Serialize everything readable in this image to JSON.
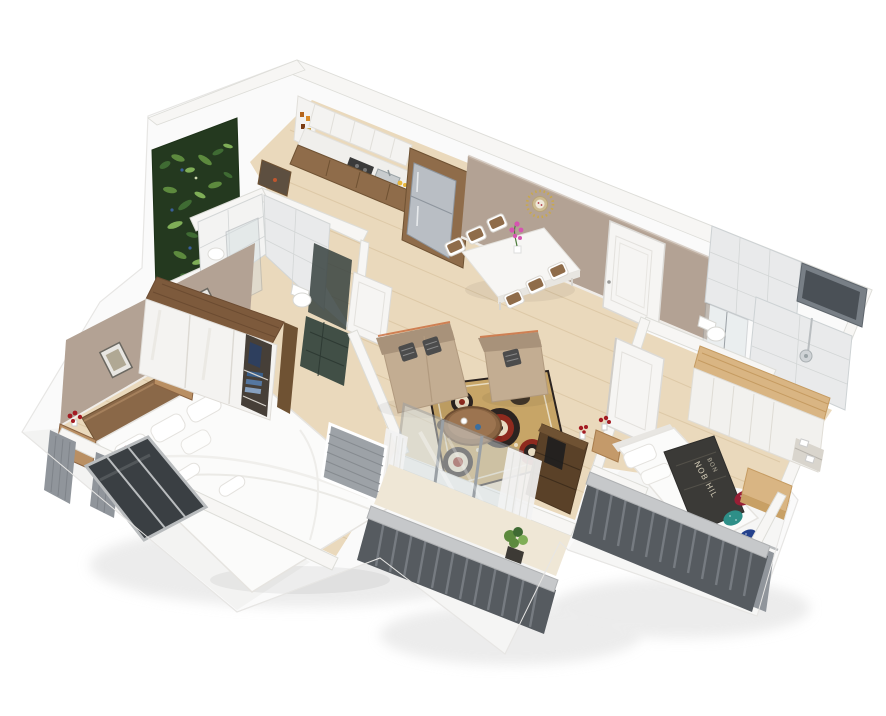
{
  "meta": {
    "description": "3D isometric cutaway render of a two-bedroom apartment floor plan on a white background",
    "width_px": 886,
    "height_px": 716
  },
  "palette": {
    "background": "#ffffff",
    "slab": "#fafafa",
    "slab_face": "#f0efee",
    "slab_edge": "#e7e6e4",
    "shadow": "#dddddd",
    "wall_white": "#f7f6f4",
    "wall_line": "#ddddd8",
    "wall_taupe": "#b3a294",
    "wall_taupe_line": "#c4b5a7",
    "floor_wood": "#ead9bc",
    "floor_plank": "#d9c4a1",
    "cabinet_white": "#f4f3f1",
    "cabinet_line": "#e1dfda",
    "counter_white": "#f0efec",
    "wood_mid": "#8f6c4a",
    "wood_dark": "#6f5233",
    "wood_light_oak": "#d9b583",
    "oak_line": "#c59b61",
    "fridge_steel": "#b9bec4",
    "fridge_dark": "#8e959d",
    "garden_dark": "#24391f",
    "leaf_green1": "#3f6b33",
    "leaf_green2": "#5d8a3e",
    "leaf_green3": "#7fae57",
    "leaf_blue": "#3a5f9a",
    "leaf_pale": "#cfd8b0",
    "tile_white": "#f3f3f2",
    "tile_large": "#e9eaeb",
    "tile_grout": "#d3d6d6",
    "glass": "#d4dde0",
    "glass_line": "#9aa0a5",
    "dark_screen": "#37423f",
    "dark_floor": "#414f46",
    "window_dark": "#3a3f43",
    "window_frame": "#b9bcbe",
    "door_white": "#f6f5f3",
    "door_line": "#dcdad6",
    "sofa": "#c3ad92",
    "sofa_dark": "#a8927a",
    "sofa_accent": "#c96a3a",
    "pillow_dark": "#4c4c4c",
    "rug_base": "#c7a567",
    "rug_dark": "#2b2320",
    "rug_red": "#8e2a1e",
    "rug_cream": "#e8dcc2",
    "bed_white": "#fbfbfa",
    "bed_line": "#e6e4e0",
    "headboard": "#8a6848",
    "blanket_dark": "#3b3a37",
    "blanket_text": "#cfc8b4",
    "pillow_red": "#981f35",
    "pillow_teal": "#2e8f88",
    "pillow_blue": "#24418c",
    "railing_dark": "#565b60",
    "railing_bar": "#7a7f85",
    "railing_light": "#c6c8ca",
    "curtain_gray": "#90959b",
    "curtain_white": "#f2f2f2",
    "louver_gray": "#9da2a7",
    "lamp_yellow": "#f2c34e",
    "flower_pink": "#d555b0",
    "flower_red": "#a31b22",
    "mirror_gold": "#c9a84c",
    "tv_dark": "#5a4128",
    "nightstand": "#b98f63"
  },
  "scene": {
    "rooms": [
      {
        "id": "kitchen",
        "furniture": [
          "white upper cabinets",
          "open corner shelves with jars",
          "countertop with hob and sink",
          "fridge in wooden housing"
        ]
      },
      {
        "id": "dining-area",
        "furniture": [
          "white dining table",
          "six wood-and-white chairs",
          "pink orchid centerpiece",
          "gold sunburst wall mirror"
        ]
      },
      {
        "id": "entry",
        "furniture": [
          "white entry door"
        ]
      },
      {
        "id": "living-room",
        "furniture": [
          "beige two-seat sofa",
          "beige armchair",
          "round wooden coffee table",
          "patterned circle rug",
          "dark wood tv cabinet",
          "sliding glass balcony door",
          "sheer white curtains"
        ]
      },
      {
        "id": "master-bedroom",
        "furniture": [
          "double bed with white bedding",
          "wooden headboard",
          "three framed pictures",
          "sliding-door wardrobe with blue clothes",
          "nightstands",
          "yellow table lamp",
          "red flowers",
          "grey window curtains",
          "dark bay window"
        ]
      },
      {
        "id": "master-bathroom",
        "furniture": [
          "white subway-tiled walls",
          "glass shower door",
          "wall toilet",
          "dark tiled floor",
          "white door"
        ]
      },
      {
        "id": "second-bedroom",
        "furniture": [
          "double bed",
          "printed dark blanket",
          "sequin pillows",
          "built-in oak wardrobe",
          "oak desk",
          "grey curtains",
          "white door",
          "red flowers console"
        ]
      },
      {
        "id": "second-bathroom",
        "furniture": [
          "large-format tiled walls",
          "glass shower partition",
          "toilet",
          "shower column",
          "high dark window"
        ]
      },
      {
        "id": "plant-wall-loggia",
        "furniture": [
          "vertical garden green wall"
        ]
      },
      {
        "id": "living-balcony",
        "furniture": [
          "grey metal railing",
          "potted plant",
          "louvre utility panel"
        ]
      },
      {
        "id": "bedroom-balcony",
        "furniture": [
          "grey metal railing"
        ]
      }
    ],
    "decor_text": {
      "bedding_print_line1": "NOB HIL",
      "bedding_print_line2": "BON"
    }
  }
}
